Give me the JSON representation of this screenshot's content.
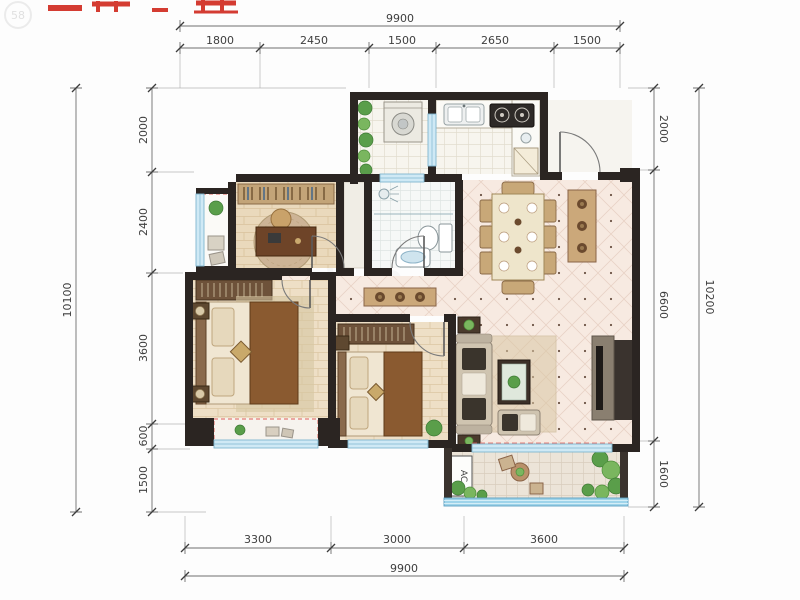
{
  "watermark": {
    "logo": "58"
  },
  "labels": {
    "ac_unit": "AC"
  },
  "dimensions": {
    "top": {
      "total": "9900",
      "segments": [
        "1800",
        "2450",
        "1500",
        "2650",
        "1500"
      ]
    },
    "bottom": {
      "total": "9900",
      "segments": [
        "3300",
        "3000",
        "3600"
      ]
    },
    "left": {
      "total": "10100",
      "segments": [
        "2000",
        "2400",
        "3600",
        "600",
        "1500"
      ]
    },
    "right": {
      "total": "10200",
      "segments": [
        "2000",
        "6600",
        "1600"
      ]
    }
  },
  "colors": {
    "wall": "#2b2522",
    "window_glass": "#cfe9f5",
    "railing_glass": "#9fd4ea",
    "tile_floor": "#f7eae1",
    "wood_floor": "#ead9bc",
    "accent_red_title": "#d43c32",
    "red_dashed_bay": "#e05c55",
    "greenery": "#5a9e4a",
    "dimension_text": "#3e3e3e"
  }
}
